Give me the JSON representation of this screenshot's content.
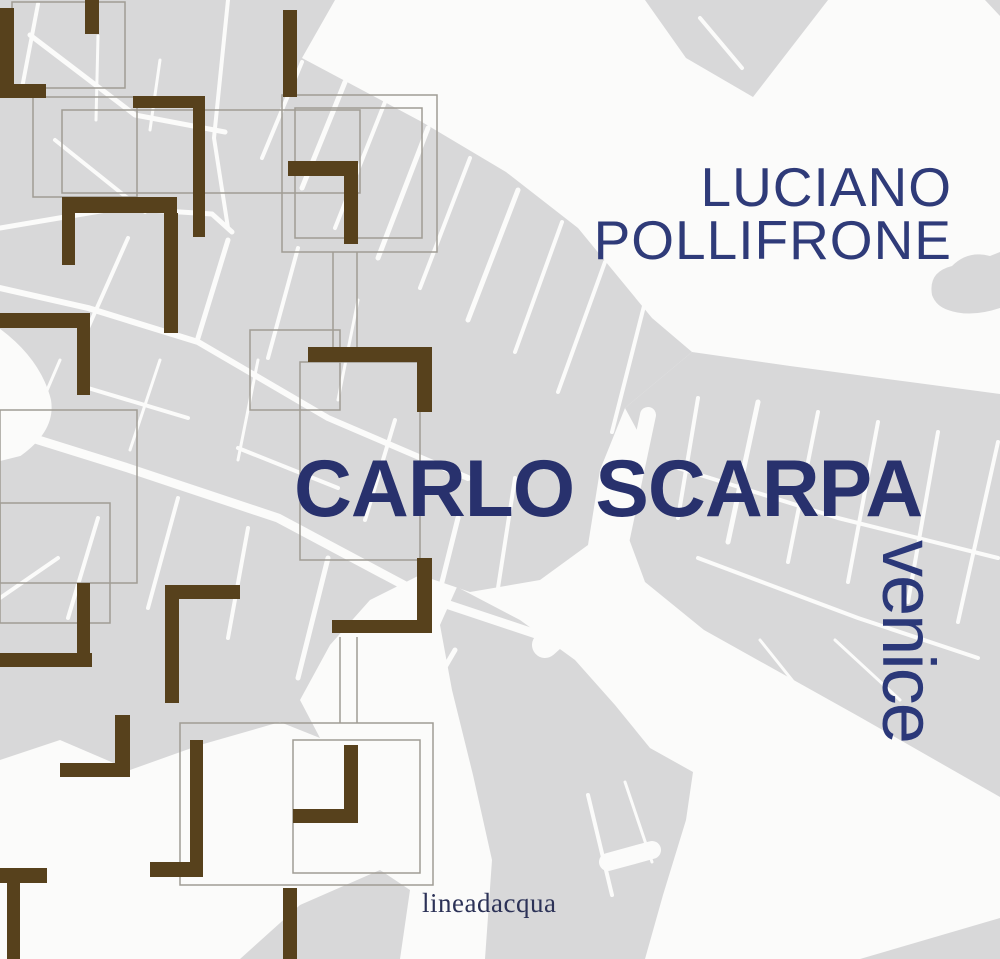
{
  "cover": {
    "author_line1": "LUCIANO",
    "author_line2": "POLLIFRONE",
    "title": "CARLO SCARPA",
    "subtitle": "venice",
    "publisher": "lineadacqua"
  },
  "colors": {
    "title_blue": "#28316d",
    "author_blue": "#2f3b79",
    "subtitle_blue": "#2b3879",
    "publisher_navy": "#2c3257",
    "map_gray": "#d8d8d9",
    "map_water_white": "#fbfbfa",
    "plan_wall_brown": "#57411c",
    "plan_outline_gray": "#a09c94"
  }
}
